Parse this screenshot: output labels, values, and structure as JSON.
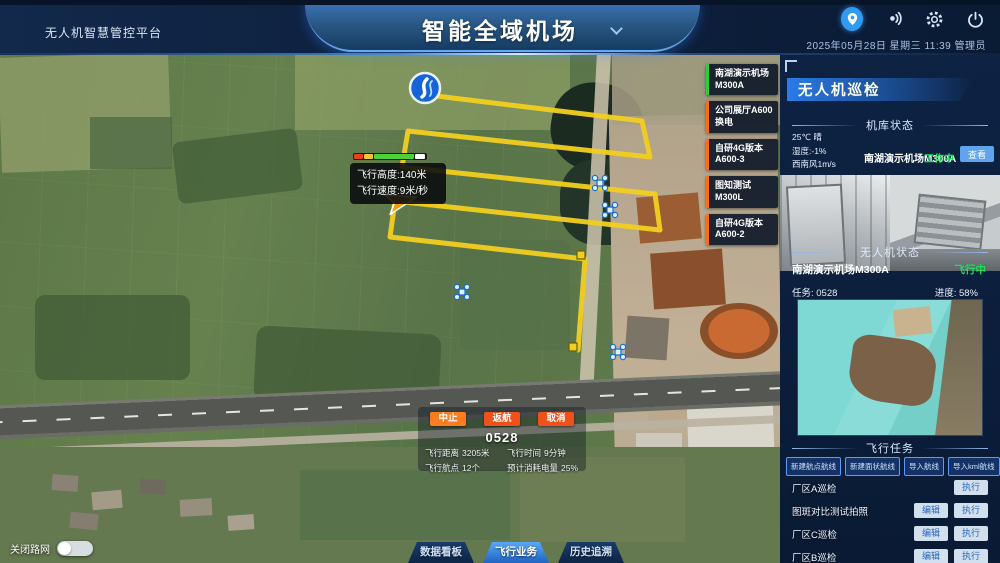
{
  "colors": {
    "accent_blue": "#2f9bf5",
    "path_yellow": "#f2cf1f",
    "status_green": "#1ae05a",
    "station_active_green": "#2ecc40",
    "station_orange": "#ff6b1a",
    "abort_orange": "#ff7d1f",
    "action_red": "#f0501a"
  },
  "header": {
    "platform_title": "无人机智慧管控平台",
    "main_title": "智能全域机场",
    "datetime": "2025年05月28日  星期三  11:39  管理员"
  },
  "map": {
    "station_buttons": [
      {
        "label": "南湖演示机场M300A",
        "color": "#2ecc40"
      },
      {
        "label": "公司展厅A600换电",
        "color": "#ff6b1a"
      },
      {
        "label": "自研4G版本A600-3",
        "color": "#ff6b1a"
      },
      {
        "label": "图知测试M300L",
        "color": "#ff6b1a"
      },
      {
        "label": "自研4G版本A600-2",
        "color": "#ff6b1a"
      }
    ],
    "tooltip": {
      "altitude": "飞行高度:140米",
      "speed": "飞行速度:9米/秒"
    },
    "road_toggle_label": "关闭路网"
  },
  "flight_panel": {
    "buttons": {
      "abort": "中止",
      "return": "返航",
      "cancel": "取消"
    },
    "task_id": "0528",
    "stats": [
      {
        "label": "飞行距离",
        "value": "3205米"
      },
      {
        "label": "飞行航点",
        "value": "12个"
      },
      {
        "label": "飞行时间",
        "value": "9分钟"
      },
      {
        "label": "预计消耗电量",
        "value": "25%"
      }
    ]
  },
  "tabs": [
    {
      "label": "数据看板",
      "active": false
    },
    {
      "label": "飞行业务",
      "active": true
    },
    {
      "label": "历史追溯",
      "active": false
    }
  ],
  "panel": {
    "title": "无人机巡检",
    "hangar_section": {
      "title": "机库状态",
      "weather": [
        "25℃ 晴",
        "湿度:-1%",
        "西南风1m/s"
      ],
      "station": "南湖演示机场M300A",
      "status": "工作中",
      "view_button": "查看"
    },
    "drone_section": {
      "title": "无人机状态",
      "station": "南湖演示机场M300A",
      "status": "飞行中",
      "task_label": "任务: 0528",
      "progress_label": "进度: 58%"
    },
    "task_section": {
      "title": "飞行任务",
      "buttons": [
        "新建航点航线",
        "新建面状航线",
        "导入航线",
        "导入kml航线"
      ],
      "tasks": [
        {
          "name": "厂区A巡检",
          "buttons": [
            "执行"
          ]
        },
        {
          "name": "图斑对比测试拍照",
          "buttons": [
            "编辑",
            "执行"
          ]
        },
        {
          "name": "厂区C巡检",
          "buttons": [
            "编辑",
            "执行"
          ]
        },
        {
          "name": "厂区B巡检",
          "buttons": [
            "编辑",
            "执行"
          ]
        }
      ]
    }
  }
}
